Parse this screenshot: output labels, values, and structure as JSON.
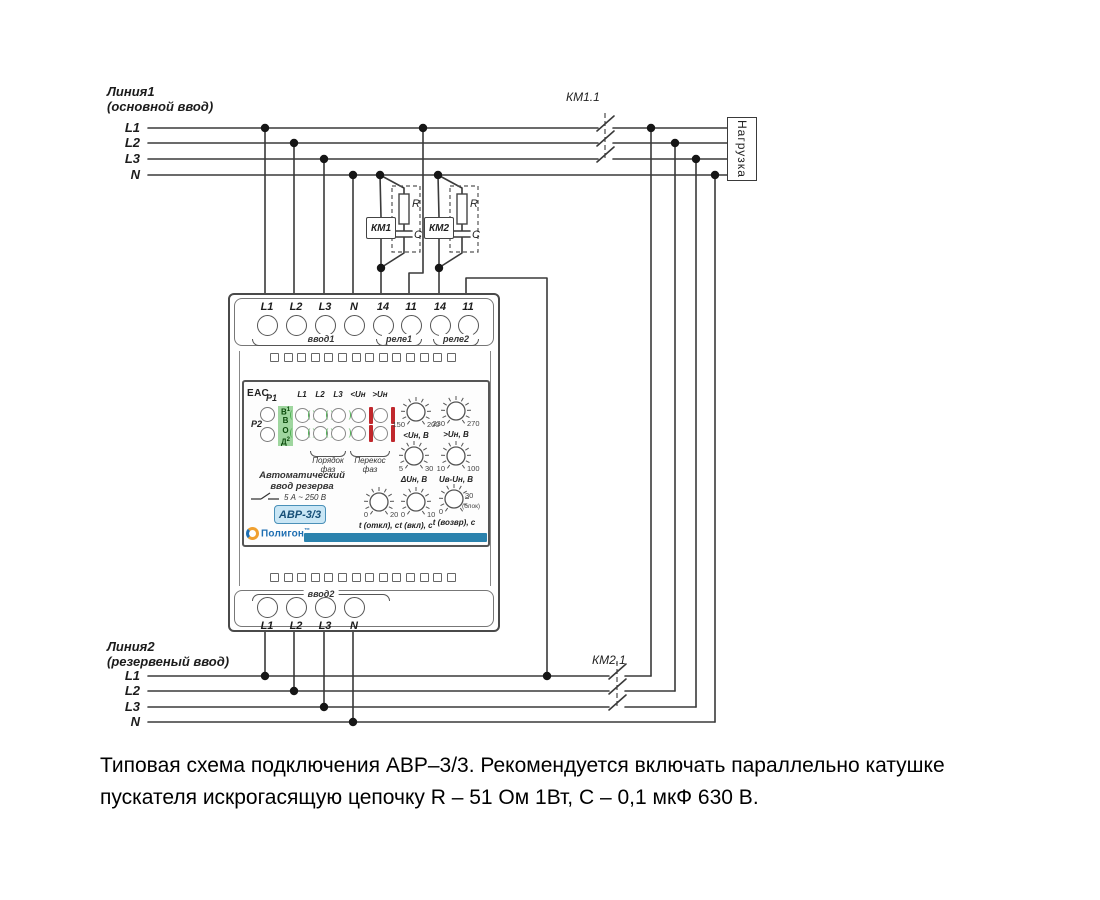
{
  "line1": {
    "title": "Линия1",
    "subtitle": "(основной ввод)",
    "wires": [
      "L1",
      "L2",
      "L3",
      "N"
    ]
  },
  "line2": {
    "title": "Линия2",
    "subtitle": "(резервеный ввод)",
    "wires": [
      "L1",
      "L2",
      "L3",
      "N"
    ]
  },
  "contactors": {
    "km11": "КМ1.1",
    "km21": "КМ2.1",
    "km1": "КМ1",
    "km2": "КМ2",
    "r": "R",
    "c": "C"
  },
  "load": {
    "label": "Нагрузка"
  },
  "device": {
    "top_terminals": [
      "L1",
      "L2",
      "L3",
      "N",
      "14",
      "11",
      "14",
      "11"
    ],
    "top_groups": [
      "ввод1",
      "реле1",
      "реле2"
    ],
    "bottom_terminals": [
      "L1",
      "L2",
      "L3",
      "N"
    ],
    "bottom_group": "ввод2",
    "panel": {
      "eac": "ЕАС",
      "p1": "P1",
      "p2": "P2",
      "vvod": [
        {
          "ch": "В",
          "idx": "1"
        },
        {
          "ch": "В",
          "idx": ""
        },
        {
          "ch": "О",
          "idx": ""
        },
        {
          "ch": "Д",
          "idx": "2"
        }
      ],
      "led_columns": [
        {
          "header": "L1",
          "type": "green"
        },
        {
          "header": "L2",
          "type": "green"
        },
        {
          "header": "L3",
          "type": "green"
        },
        {
          "header": "<Uн",
          "type": "red"
        },
        {
          "header": ">Uн",
          "type": "red"
        }
      ],
      "bracket1": {
        "line1": "Порядок",
        "line2": "фаз"
      },
      "bracket2": {
        "line1": "Перекос",
        "line2": "фаз"
      },
      "title_line1": "Автоматический",
      "title_line2": "ввод резерва",
      "rating": "5 А ~ 250 В",
      "model": "АВР-3/3",
      "brand": "Полигон",
      "brand_tm": "™",
      "knobs": [
        {
          "left": "150",
          "right": "200",
          "caption": "<Uн, В"
        },
        {
          "left": "230",
          "right": "270",
          "caption": ">Uн, В"
        },
        {
          "left": "5",
          "right": "30",
          "caption": "ΔUн, В"
        },
        {
          "left": "10",
          "right": "100",
          "caption": "Uв-Uн, В"
        },
        {
          "left": "0",
          "right": "20",
          "caption": "t (откл), с"
        },
        {
          "left": "0",
          "right": "10",
          "caption": "t (вкл), с"
        },
        {
          "left": "0",
          "right": "30",
          "caption": "t (возвр), с",
          "note": "(блок)"
        }
      ]
    }
  },
  "caption": "Типовая схема подключения АВР–3/3. Рекомендуется включать параллельно катушке пускателя искрогасящую цепочку R – 51 Ом 1Вт, С – 0,1 мкФ 630 В.",
  "colors": {
    "wire": "#3a3a3a",
    "green": "#4caf50",
    "green_bg": "#9fd69f",
    "red": "#c0282d",
    "accent": "#2b82ad",
    "badge_bg": "#c9e6f5",
    "badge_border": "#4a90b8",
    "badge_text": "#174f77",
    "brand_blue": "#1f6fb2",
    "brand_orange": "#f0a030"
  }
}
